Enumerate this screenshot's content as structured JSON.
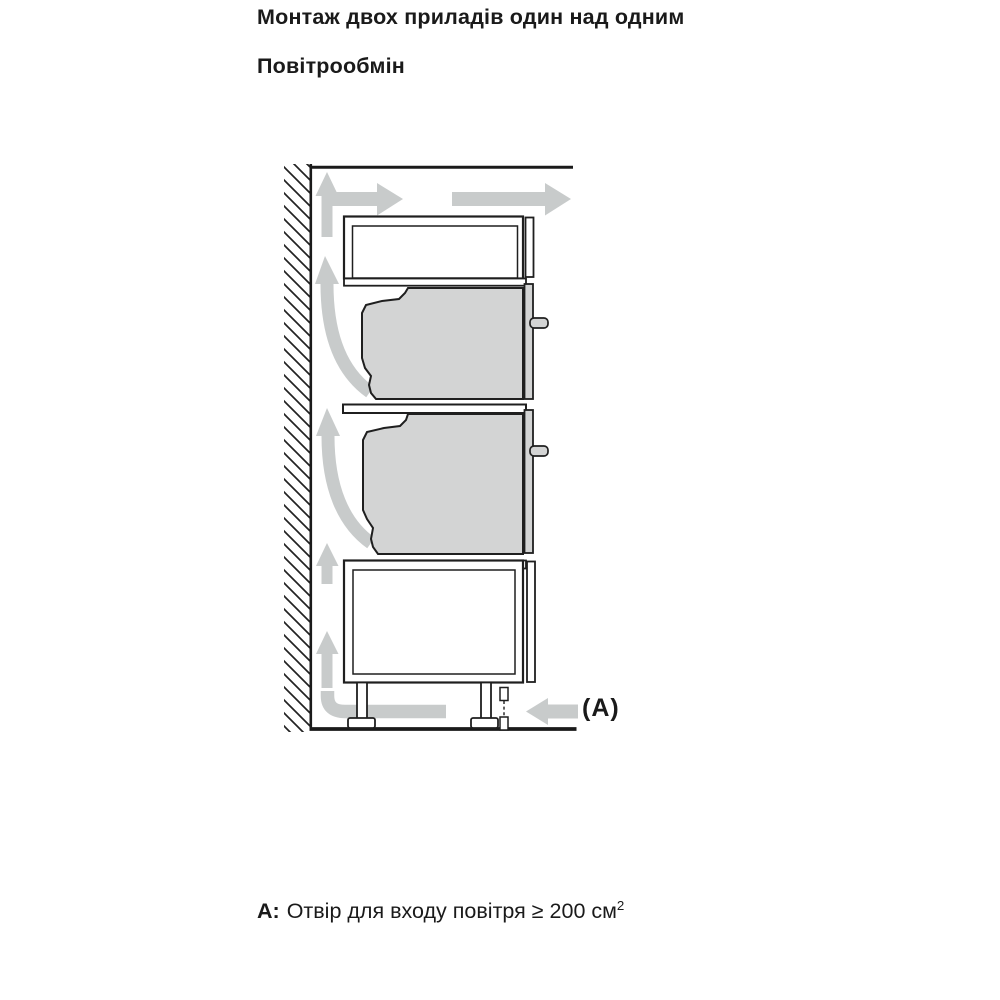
{
  "page": {
    "title": "Монтаж двох приладів один над одним",
    "subtitle": "Повітрообмін"
  },
  "note": {
    "label": "A:",
    "text": "Отвір для входу повітря ≥ 200 см",
    "superscript": "2"
  },
  "diagram": {
    "label_a": "(A)",
    "colors": {
      "outline": "#1f1f1f",
      "appliance_fill": "#d3d4d4",
      "airflow_arrow": "#c8cbcb",
      "hatch_line": "#222222"
    },
    "elements": {
      "wall": "hatched-wall-section",
      "top_compartment": "ventilation-compartment",
      "upper_appliance": "compact-oven-side-view",
      "lower_appliance": "oven-side-view",
      "base_cabinet": "base-cabinet-with-adjustable-feet",
      "airflow": "air-circulation-arrows",
      "intake": "air-intake-opening-A"
    }
  }
}
